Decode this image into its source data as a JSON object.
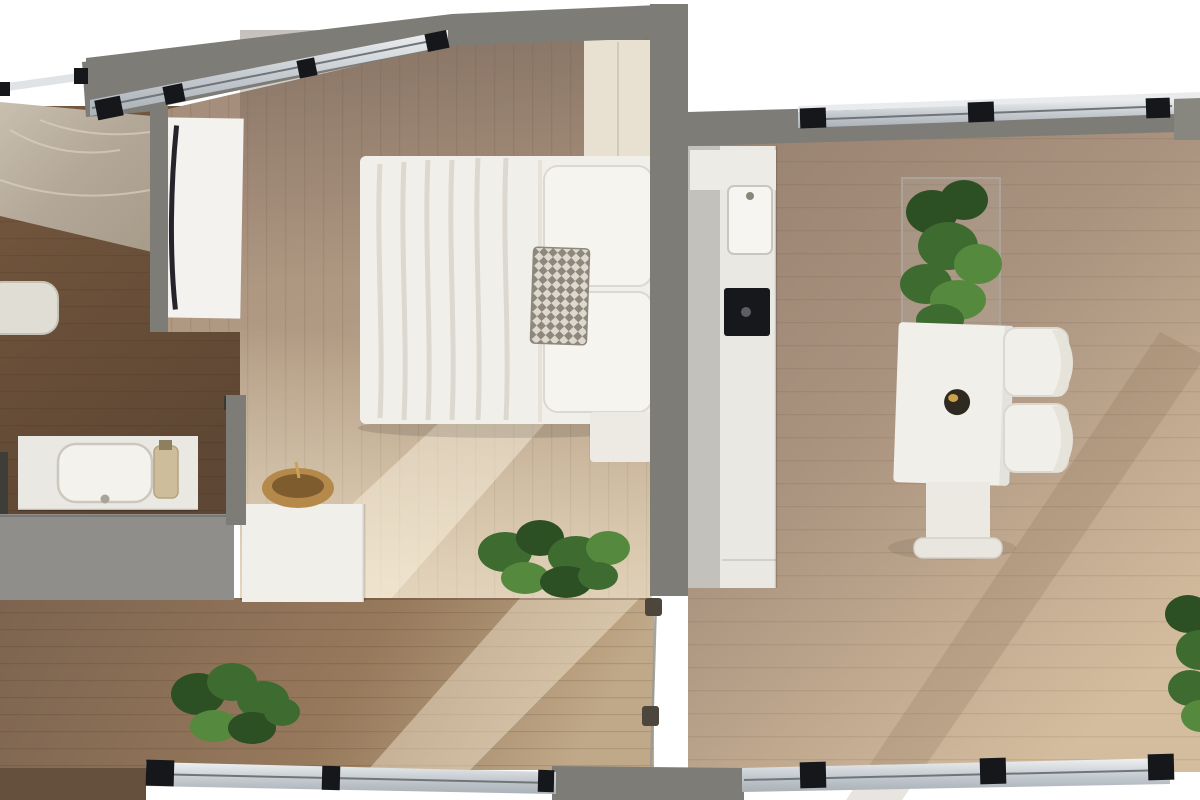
{
  "scene": {
    "title": "Apartment floor plan 3D render",
    "view": "top-down-render",
    "background": "#ffffff"
  },
  "palette": {
    "wall": "#7d7c77",
    "wallDark": "#87867f",
    "windowFrame": "#ccd1d5",
    "windowMullion": "#15171b",
    "marbleVein": "#d8d0c2",
    "floorBath": "#6e5440",
    "floorBedroom": "#a8927e",
    "floorHall": "#8c7157",
    "floorLiving": "#a58d7b",
    "furnitureWhite": "#f1efea",
    "furnitureCream": "#e8e1d1",
    "counterWhite": "#eae8e3",
    "cabinetGray": "#c3c1bc",
    "applianceBlack": "#17181b",
    "doorWhite": "#f4f2ee",
    "doorEdgeDark": "#24242a",
    "grayBlock": "#8f8e8a",
    "glassLine": "#9b9a96",
    "handleDark": "#4c463c",
    "plantDark": "#2c4f23",
    "plantMid": "#3e6b30",
    "plantLight": "#558a3e",
    "woodBowl": "#b5894a",
    "bowlInner": "#7e5c2e",
    "toiletWhite": "#e0ddd4",
    "railDark": "#3f3d38"
  },
  "rooms": [
    {
      "id": "bathroom",
      "name": "Bathroom",
      "furniture": [
        "marble shower area",
        "toilet",
        "vanity counter with sink",
        "soap bottle",
        "towel rail"
      ]
    },
    {
      "id": "bedroom",
      "name": "Bedroom",
      "furniture": [
        "double bed with white bedding",
        "two pillows",
        "patterned throw pillow",
        "cream wardrobe",
        "white open door",
        "bench",
        "white desk",
        "wooden bowl",
        "floor plant"
      ]
    },
    {
      "id": "hallway",
      "name": "Hallway",
      "furniture": [
        "floor plant",
        "gray storage block"
      ]
    },
    {
      "id": "living-kitchen",
      "name": "Living room with kitchen",
      "furniture": [
        "kitchen cabinet run",
        "kitchen sink",
        "black cooktop appliance",
        "framed planter with tall plant",
        "white dining table",
        "dark vase",
        "two white chairs",
        "pedestal stand",
        "floor plant at right edge",
        "glass partition door"
      ]
    }
  ],
  "openings": {
    "windows": [
      "top-left window band",
      "top-right window band",
      "bottom-left window band",
      "bottom-right window band"
    ],
    "doors": [
      "bathroom white door",
      "glass partition door"
    ]
  }
}
